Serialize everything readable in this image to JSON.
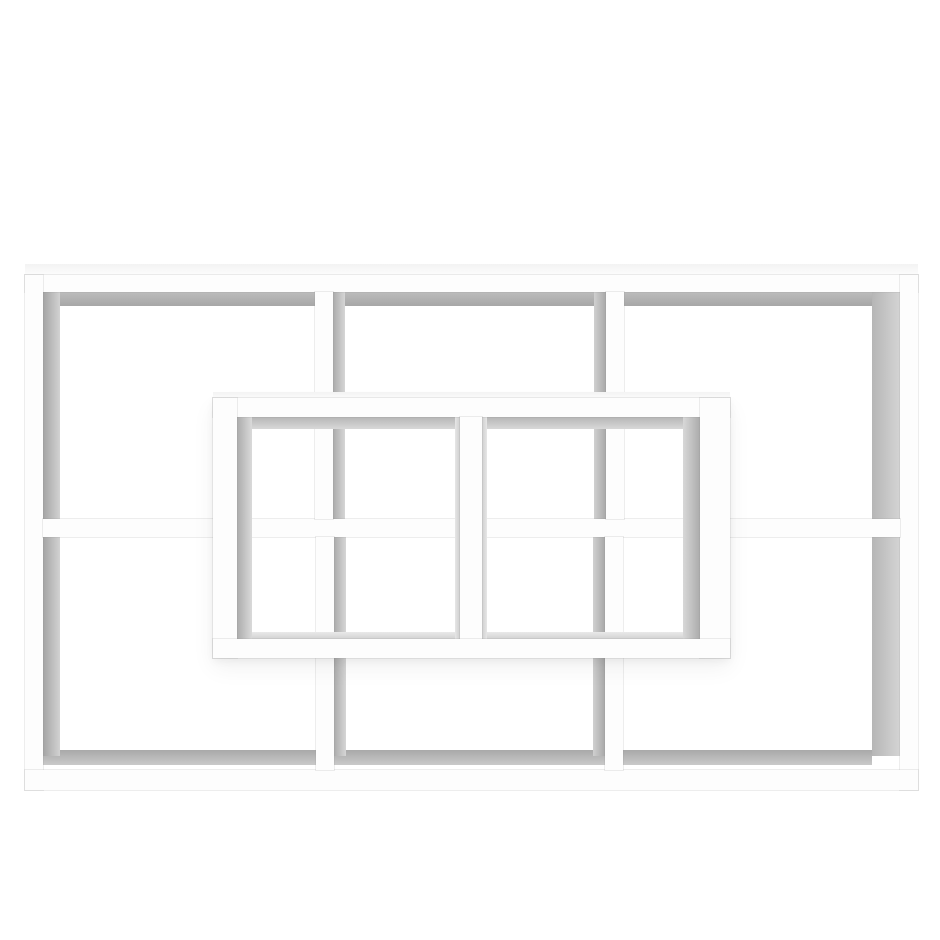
{
  "scene": {
    "description": "Product photo of a white wall-mounted floating shelf with eight open compartments, photographed straight-on against a plain white background. A rectangular outer frame holds three upper and three lower compartments, and a two-compartment rectangular box protrudes forward from the center.",
    "product_name": "floating-wall-shelf",
    "finish_color_name": "white",
    "back_compartments": 6,
    "front_compartments": 2,
    "total_compartments": 8
  },
  "palette": {
    "background": "#ffffff",
    "board_white": "#fdfdfd",
    "inner_shadow_dark": "#a6a6a6",
    "inner_shadow_light": "#d6d6d6",
    "sheen": "#f3f3f3",
    "seam_hairline": "rgba(145,145,145,0.16)"
  },
  "shapes": [
    {
      "n": "shelf-top-surface-sheen",
      "k": "shade",
      "x": 25,
      "y": 264,
      "w": 893,
      "h": 11,
      "g": {
        "d": "b",
        "f": "#f3f3f3",
        "t": "#fcfcfc"
      }
    },
    {
      "n": "under-top-shade-left",
      "k": "shade",
      "x": 43,
      "y": 292,
      "w": 272,
      "h": 14,
      "g": {
        "d": "b",
        "f": "#bcbcbc",
        "t": "#a7a7a7"
      }
    },
    {
      "n": "under-top-shade-middle",
      "k": "shade",
      "x": 333,
      "y": 292,
      "w": 273,
      "h": 14,
      "g": {
        "d": "b",
        "f": "#bcbcbc",
        "t": "#a7a7a7"
      }
    },
    {
      "n": "under-top-shade-right",
      "k": "shade",
      "x": 624,
      "y": 292,
      "w": 248,
      "h": 14,
      "g": {
        "d": "b",
        "f": "#bcbcbc",
        "t": "#a7a7a7"
      }
    },
    {
      "n": "left-wall-inner-flank-top",
      "k": "shade",
      "x": 43,
      "y": 292,
      "w": 17,
      "h": 227,
      "g": {
        "d": "r",
        "f": "#a4a4a4",
        "t": "#d2d2d2"
      }
    },
    {
      "n": "divider1-inner-flank-top",
      "k": "shade",
      "x": 333,
      "y": 292,
      "w": 12,
      "h": 227,
      "g": {
        "d": "r",
        "f": "#ababab",
        "t": "#d6d6d6"
      }
    },
    {
      "n": "divider2-inner-flank-top",
      "k": "shade",
      "x": 594,
      "y": 292,
      "w": 12,
      "h": 227,
      "g": {
        "d": "r",
        "f": "#d0d0d0",
        "t": "#a8a8a8"
      }
    },
    {
      "n": "right-wall-inner-flank-top",
      "k": "shade",
      "x": 872,
      "y": 292,
      "w": 28,
      "h": 227,
      "g": {
        "d": "r",
        "f": "#b6b6b6",
        "t": "#d4d4d4"
      }
    },
    {
      "n": "above-bottom-shade-left",
      "k": "shade",
      "x": 43,
      "y": 750,
      "w": 273,
      "h": 15,
      "g": {
        "d": "b",
        "f": "#a9a9a9",
        "t": "#c9c9c9"
      }
    },
    {
      "n": "above-bottom-shade-middle",
      "k": "shade",
      "x": 334,
      "y": 750,
      "w": 271,
      "h": 15,
      "g": {
        "d": "b",
        "f": "#a9a9a9",
        "t": "#c9c9c9"
      }
    },
    {
      "n": "above-bottom-shade-right",
      "k": "shade",
      "x": 623,
      "y": 750,
      "w": 249,
      "h": 15,
      "g": {
        "d": "b",
        "f": "#a9a9a9",
        "t": "#c9c9c9"
      }
    },
    {
      "n": "left-wall-inner-flank-bottom",
      "k": "shade",
      "x": 43,
      "y": 537,
      "w": 17,
      "h": 219,
      "g": {
        "d": "r",
        "f": "#a4a4a4",
        "t": "#d2d2d2"
      }
    },
    {
      "n": "divider1-inner-flank-bottom",
      "k": "shade",
      "x": 334,
      "y": 537,
      "w": 12,
      "h": 219,
      "g": {
        "d": "r",
        "f": "#ababab",
        "t": "#d6d6d6"
      }
    },
    {
      "n": "divider2-inner-flank-bottom",
      "k": "shade",
      "x": 593,
      "y": 537,
      "w": 12,
      "h": 219,
      "g": {
        "d": "r",
        "f": "#d0d0d0",
        "t": "#a8a8a8"
      }
    },
    {
      "n": "right-wall-inner-flank-bottom",
      "k": "shade",
      "x": 872,
      "y": 537,
      "w": 28,
      "h": 219,
      "g": {
        "d": "r",
        "f": "#b6b6b6",
        "t": "#d4d4d4"
      }
    },
    {
      "n": "outer-top-board",
      "k": "board",
      "x": 25,
      "y": 275,
      "w": 893,
      "h": 17
    },
    {
      "n": "outer-left-board",
      "k": "board",
      "x": 25,
      "y": 275,
      "w": 18,
      "h": 515
    },
    {
      "n": "outer-right-board",
      "k": "board",
      "x": 900,
      "y": 275,
      "w": 18,
      "h": 515
    },
    {
      "n": "outer-bottom-board",
      "k": "board",
      "x": 25,
      "y": 770,
      "w": 893,
      "h": 20
    },
    {
      "n": "middle-shelf-board",
      "k": "board",
      "x": 43,
      "y": 519,
      "w": 857,
      "h": 18
    },
    {
      "n": "top-divider-1",
      "k": "board",
      "x": 315,
      "y": 292,
      "w": 18,
      "h": 227
    },
    {
      "n": "top-divider-2",
      "k": "board",
      "x": 606,
      "y": 292,
      "w": 18,
      "h": 227
    },
    {
      "n": "bottom-divider-1",
      "k": "board",
      "x": 316,
      "y": 537,
      "w": 18,
      "h": 233
    },
    {
      "n": "bottom-divider-2",
      "k": "board",
      "x": 605,
      "y": 537,
      "w": 18,
      "h": 233
    },
    {
      "n": "front-box-shadow-halo",
      "k": "halo",
      "x": 213,
      "y": 398,
      "w": 517,
      "h": 260
    },
    {
      "n": "front-box-top-surface-sheen",
      "k": "shade",
      "x": 213,
      "y": 392,
      "w": 517,
      "h": 6,
      "g": {
        "d": "b",
        "f": "#f3f3f3",
        "t": "#fbfbfb"
      }
    },
    {
      "n": "front-box-under-top-shade-left",
      "k": "shade",
      "x": 237,
      "y": 417,
      "w": 223,
      "h": 12,
      "g": {
        "d": "b",
        "f": "#b6b6b6",
        "t": "#d8d8d8"
      }
    },
    {
      "n": "front-box-under-top-shade-right",
      "k": "shade",
      "x": 482,
      "y": 417,
      "w": 218,
      "h": 12,
      "g": {
        "d": "b",
        "f": "#b6b6b6",
        "t": "#d8d8d8"
      }
    },
    {
      "n": "front-box-cell1-left-flank",
      "k": "shade",
      "x": 237,
      "y": 417,
      "w": 15,
      "h": 222,
      "g": {
        "d": "r",
        "f": "#ababab",
        "t": "#dadada"
      }
    },
    {
      "n": "front-box-cell2-right-flank",
      "k": "shade",
      "x": 683,
      "y": 417,
      "w": 17,
      "h": 222,
      "g": {
        "d": "r",
        "f": "#d8d8d8",
        "t": "#ababab"
      }
    },
    {
      "n": "front-box-divider-left-seam",
      "k": "shade",
      "x": 455,
      "y": 417,
      "w": 5,
      "h": 222,
      "g": {
        "d": "r",
        "f": "#e6e6e6",
        "t": "#cfcfcf"
      }
    },
    {
      "n": "front-box-divider-right-seam",
      "k": "shade",
      "x": 482,
      "y": 417,
      "w": 5,
      "h": 222,
      "g": {
        "d": "r",
        "f": "#cfcfcf",
        "t": "#e6e6e6"
      }
    },
    {
      "n": "front-box-above-bottom-shade-left",
      "k": "shade",
      "x": 252,
      "y": 632,
      "w": 203,
      "h": 7,
      "g": {
        "d": "b",
        "f": "#e9e9e9",
        "t": "#d2d2d2"
      }
    },
    {
      "n": "front-box-above-bottom-shade-right",
      "k": "shade",
      "x": 487,
      "y": 632,
      "w": 196,
      "h": 7,
      "g": {
        "d": "b",
        "f": "#e9e9e9",
        "t": "#d2d2d2"
      }
    },
    {
      "n": "front-box-top-board",
      "k": "board",
      "x": 213,
      "y": 398,
      "w": 517,
      "h": 19
    },
    {
      "n": "front-box-left-board",
      "k": "board",
      "x": 213,
      "y": 398,
      "w": 24,
      "h": 260
    },
    {
      "n": "front-box-right-board",
      "k": "board",
      "x": 700,
      "y": 398,
      "w": 30,
      "h": 260
    },
    {
      "n": "front-box-center-divider-board",
      "k": "board",
      "x": 460,
      "y": 417,
      "w": 22,
      "h": 222
    },
    {
      "n": "front-box-bottom-board",
      "k": "board",
      "x": 213,
      "y": 639,
      "w": 517,
      "h": 19
    }
  ]
}
